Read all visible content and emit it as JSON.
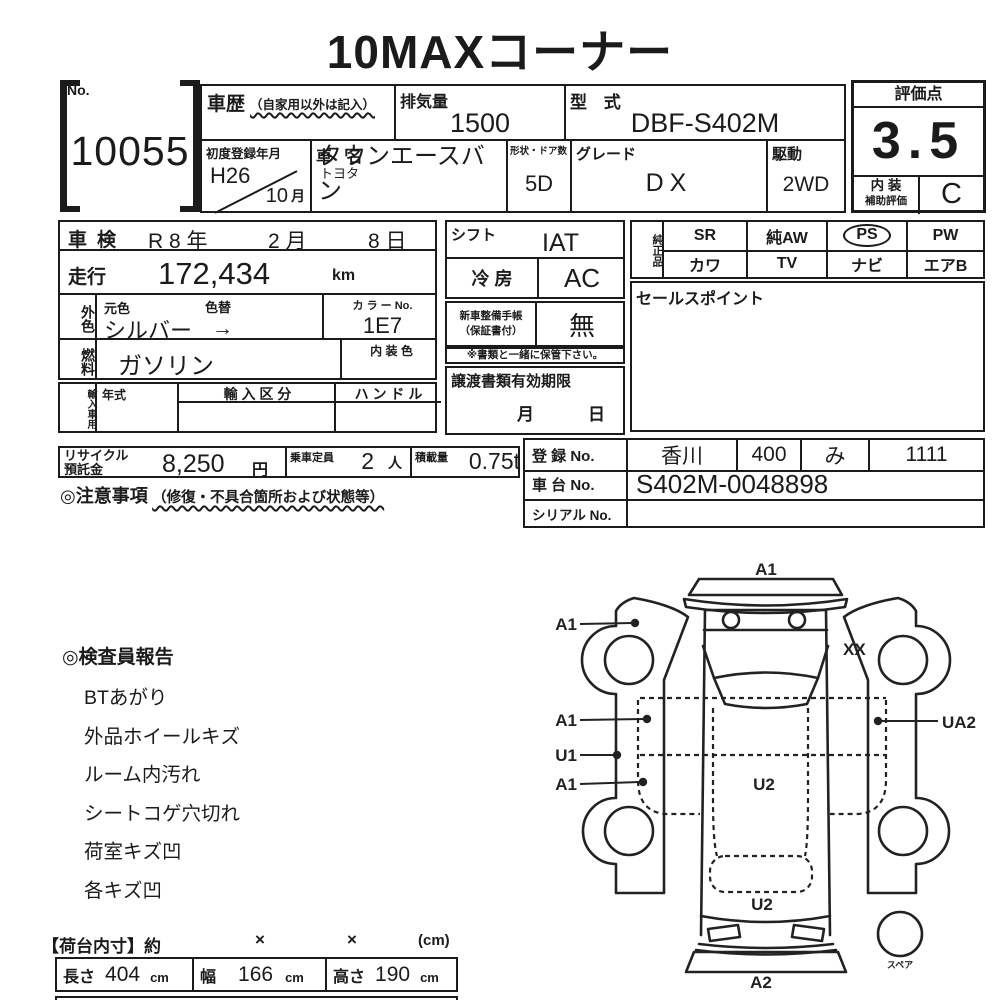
{
  "title": "10MAXコーナー",
  "no_box": {
    "label": "No.",
    "value": "10055"
  },
  "top": {
    "shareki": {
      "label": "車歴",
      "note": "（自家用以外は記入）"
    },
    "haikiryo": {
      "label": "排気量",
      "value": "1500"
    },
    "katashiki": {
      "label": "型 式",
      "value": "DBF-S402M"
    },
    "shodo": {
      "label": "初度登録年月",
      "year": "H26",
      "month": "10",
      "month_suffix": "月"
    },
    "shamei": {
      "label": "車 名",
      "maker": "トヨタ",
      "model": "タウンエースバン"
    },
    "keijo": {
      "label": "形状・ドア数",
      "value": "5D"
    },
    "grade": {
      "label": "グレード",
      "value": "DX"
    },
    "kudo": {
      "label": "駆動",
      "value": "2WD"
    },
    "hyoka": {
      "label": "評価点",
      "score": "3.5",
      "naiso_label": "内 装",
      "hojo_label": "補助評価",
      "naiso_grade": "C"
    }
  },
  "left": {
    "shaken": {
      "label": "車検",
      "era": "R 8 年",
      "month": "2 月",
      "day": "8 日"
    },
    "soko": {
      "label": "走行",
      "value": "172,434",
      "unit": "km"
    },
    "gaishoku": {
      "label": "外色",
      "motoiro": "元色",
      "iroga": "色替",
      "value": "シルバー",
      "arrow": "→",
      "colorno_label": "カ ラ ー No.",
      "colorno": "1E7"
    },
    "nenryo": {
      "label": "燃料",
      "value": "ガソリン",
      "naiso_label": "内 装 色"
    },
    "yunyu": {
      "label": "輸入車用",
      "nenshiki": "年式",
      "kubun": "輸 入 区 分",
      "handle": "ハ ン ド ル"
    },
    "recycle": {
      "label1": "リサイクル",
      "label2": "預託金",
      "value": "8,250",
      "unit": "円",
      "josha_label": "乗車定員",
      "josha": "2",
      "josha_unit": "人",
      "sekisai_label": "積載量",
      "sekisai": "0.75t"
    },
    "chui": {
      "label": "◎注意事項",
      "note": "（修復・不具合箇所および状態等）"
    }
  },
  "mid": {
    "shift": {
      "label": "シフト",
      "value": "IAT"
    },
    "reibo": {
      "label": "冷 房",
      "value": "AC"
    },
    "techo": {
      "label1": "新車整備手帳",
      "label2": "（保証書付）",
      "value": "無"
    },
    "hokan_note": "※書類と一緒に保管下さい。",
    "joto": {
      "label": "譲渡書類有効期限",
      "month": "月",
      "day": "日"
    }
  },
  "right": {
    "junsei": {
      "label": "純正品",
      "row1": [
        "SR",
        "純AW",
        "PS",
        "PW"
      ],
      "row2": [
        "カワ",
        "TV",
        "ナビ",
        "エアB"
      ],
      "circled": "PS"
    },
    "sales_label": "セールスポイント",
    "toroku": {
      "label": "登 録 No.",
      "v1": "香川",
      "v2": "400",
      "v3": "み",
      "v4": "1111"
    },
    "shadai": {
      "label": "車 台 No.",
      "value": "S402M-0048898"
    },
    "serial": {
      "label": "シリアル No."
    }
  },
  "report": {
    "title": "◎検査員報告",
    "items": [
      "BTあがり",
      "外品ホイールキズ",
      "ルーム内汚れ",
      "シートコゲ穴切れ",
      "荷室キズ凹",
      "各キズ凹"
    ]
  },
  "dims": {
    "header": "【荷台内寸】約",
    "x1": "×",
    "x2": "×",
    "unit": "(cm)",
    "rows": [
      {
        "label": "長さ",
        "value": "404",
        "unit": "cm"
      },
      {
        "label": "幅",
        "value": "166",
        "unit": "cm"
      },
      {
        "label": "高さ",
        "value": "190",
        "unit": "cm"
      }
    ]
  },
  "diagram": {
    "front": "A1",
    "left_fender": "A1",
    "left_mid": "A1",
    "left_rocker": "U1",
    "left_lower": "A1",
    "right_pillar": "XX",
    "right_side": "UA2",
    "cargo": "U2",
    "rear_window": "U2",
    "rear_bumper": "A2",
    "spare": "スペア"
  },
  "colors": {
    "ink": "#1b1b1b",
    "paper": "#ffffff"
  }
}
